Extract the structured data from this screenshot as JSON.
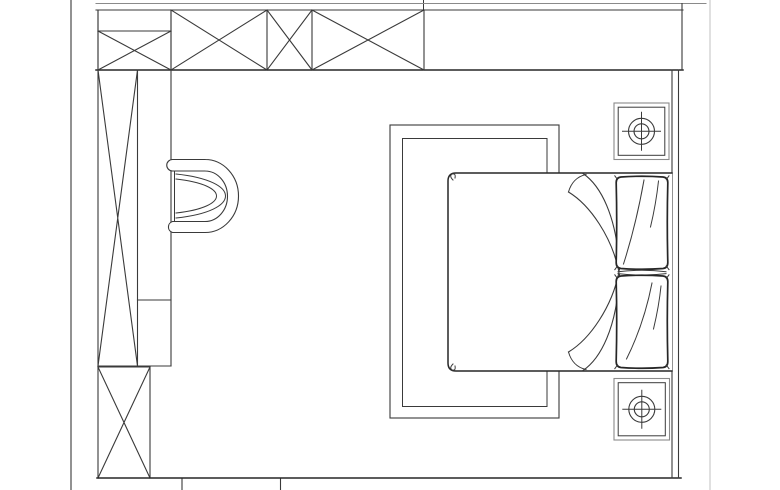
{
  "document": {
    "title": "Bedroom furniture floor plan",
    "drawing_type": "2D CAD line drawing, top (plan) view",
    "has_text_labels": false
  },
  "colors": {
    "background": "#ffffff",
    "line_primary": "#3a3a3a",
    "line_strong": "#262626",
    "line_muted": "#8a8a8a",
    "sheet_edge": "#d5d5d5"
  },
  "plan": {
    "room": {
      "top_wall_band": {
        "x": 96,
        "y": 10,
        "width": 587,
        "height": 60,
        "panels": [
          {
            "name": "divided-panel",
            "x1": 98,
            "x2": 171,
            "divider_y": 31,
            "hatch": "x-lower-half"
          },
          {
            "name": "window-panel-1",
            "x1": 171,
            "x2": 267,
            "hatch": "x"
          },
          {
            "name": "window-panel-2",
            "x1": 267,
            "x2": 312,
            "hatch": "x"
          },
          {
            "name": "window-panel-3",
            "x1": 312,
            "x2": 424,
            "hatch": "x"
          },
          {
            "name": "plain-wall-segment",
            "x1": 424,
            "x2": 683,
            "hatch": "none"
          }
        ]
      },
      "left_wall_x": 71,
      "sheet_edge_x": 710,
      "right_wall": {
        "x1": 672,
        "x2": 678.5,
        "y1": 70,
        "y2": 478
      },
      "bottom_wall_y": 478,
      "bottom_ticks_x": [
        182,
        280.5
      ]
    },
    "furniture": [
      {
        "name": "tall-wardrobe",
        "bbox": [
          98,
          70,
          137.5,
          366
        ],
        "symbol": "elongated-x-box"
      },
      {
        "name": "wardrobe-side-strip",
        "bbox": [
          137.5,
          70,
          171,
          366
        ],
        "divider_y": 300
      },
      {
        "name": "base-cabinet",
        "bbox": [
          98,
          367,
          150,
          478
        ],
        "symbol": "x-box"
      },
      {
        "name": "armchair",
        "bbox": [
          166,
          159,
          241,
          233
        ],
        "orientation": "facing-left"
      },
      {
        "name": "area-rug",
        "outer_bbox": [
          390,
          125,
          559,
          418
        ],
        "inner_bbox": [
          402.5,
          138.5,
          547,
          406.5
        ]
      },
      {
        "name": "double-bed",
        "bbox": [
          448,
          173,
          672,
          371
        ],
        "head_side": "right"
      },
      {
        "name": "pillow-top",
        "bbox": [
          615.5,
          175,
          668.5,
          270
        ]
      },
      {
        "name": "pillow-bottom",
        "bbox": [
          615.5,
          274,
          668.5,
          369
        ]
      },
      {
        "name": "nightstand-top",
        "bbox": [
          614,
          103,
          669,
          159.5
        ],
        "symbol": "circle-crosshair-lamp"
      },
      {
        "name": "nightstand-bottom",
        "bbox": [
          614,
          378.5,
          669.5,
          440
        ],
        "symbol": "circle-crosshair-lamp"
      }
    ]
  }
}
